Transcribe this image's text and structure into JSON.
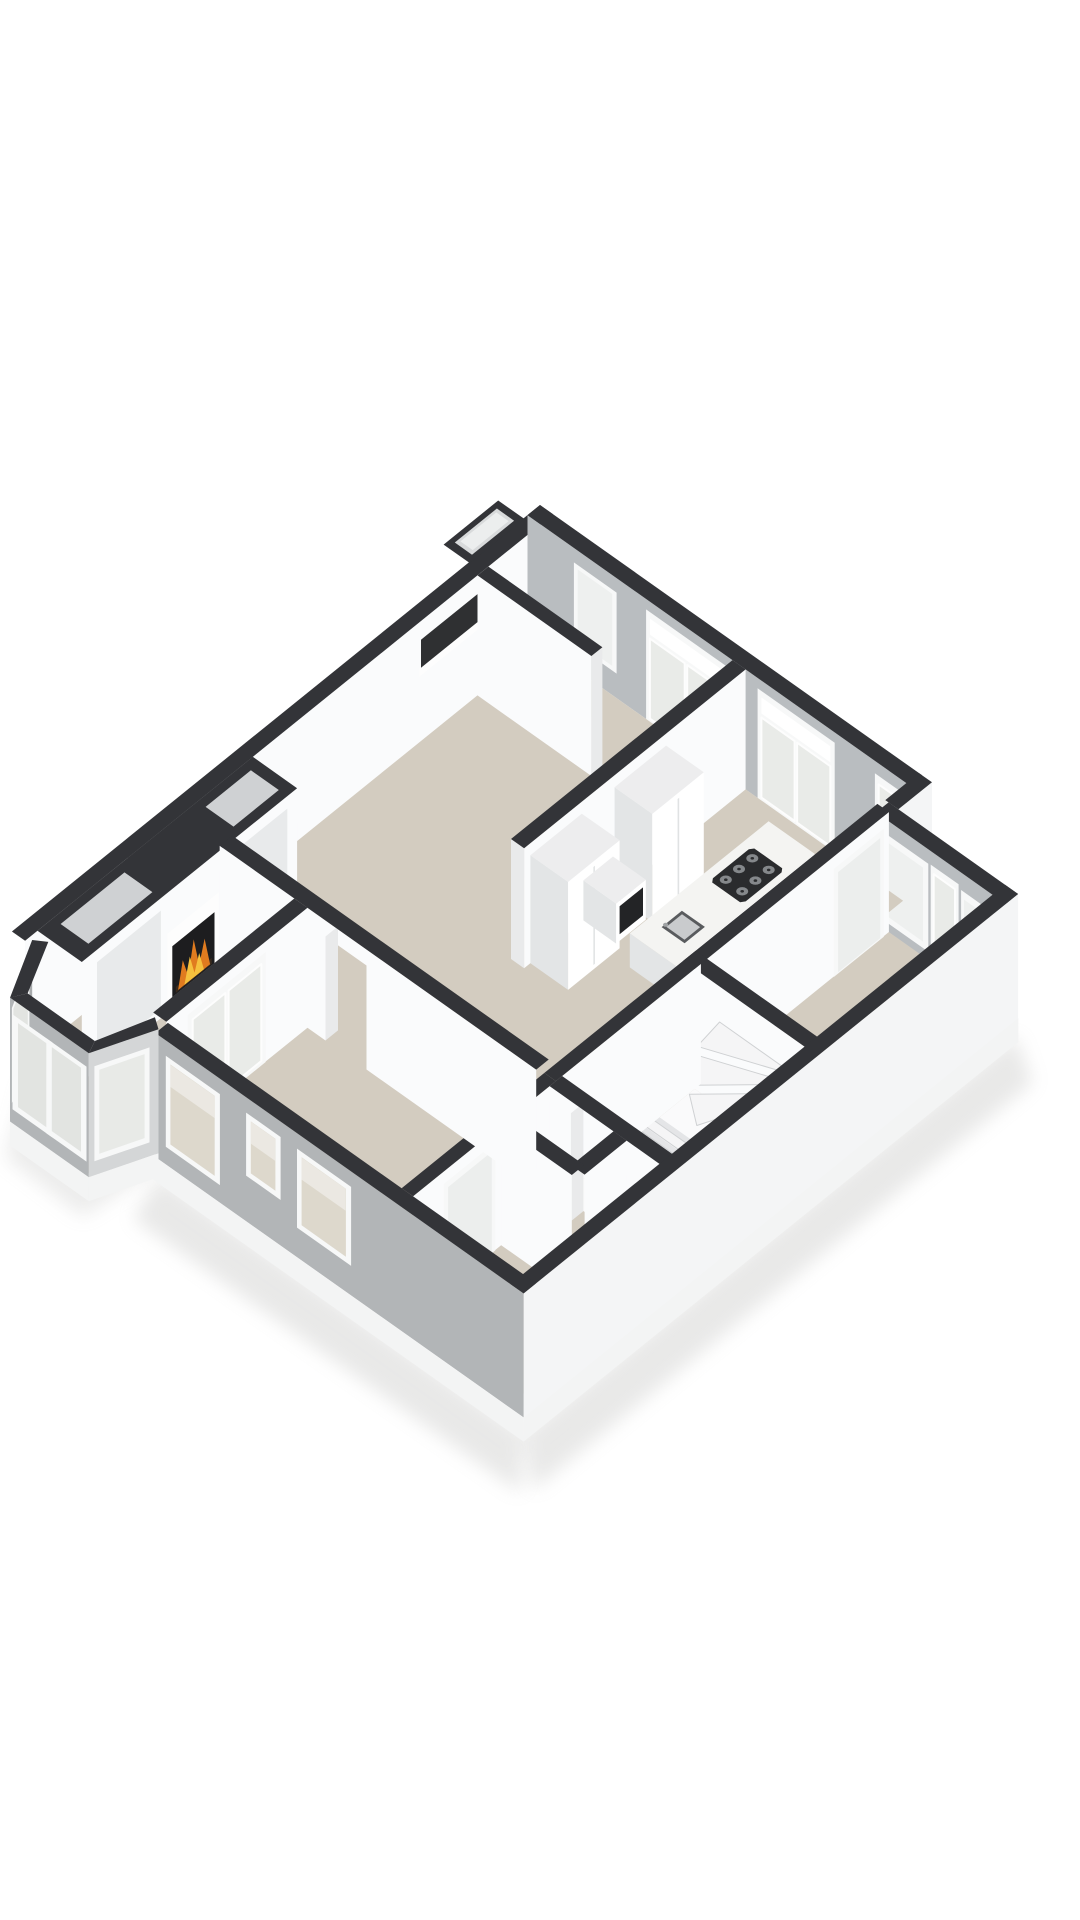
{
  "scene": {
    "label": "3D floor plan of a ground floor with living room with fireplace and bay window, galley kitchen with island, dining room, hallway and winding staircase",
    "background": "#ffffff"
  },
  "palette": {
    "floor": "#d3ccc0",
    "floorBay": "#d7d1c5",
    "stairFloor": "#fafafb",
    "wallTop": "#333438",
    "wallTopInt": "#3a3b3f",
    "intWhite": "#fafbfc",
    "intWhite2": "#f1f2f3",
    "intGrey": "#b9bdc0",
    "jamb": "#e9eaeb",
    "extGrey": "#b2b5b7",
    "extGreyDark": "#a7aaac",
    "extLight": "#f4f5f6",
    "slab": "#f3f4f4",
    "frame": "#f7f8f8",
    "glassInt": "#eef0ef",
    "glassDoor": "#e9ebe8",
    "glassExt": "#ddd8cc",
    "glassBay": "#e2e4e1",
    "nicheTop": "#cfd1d3",
    "nichePanel": "#e8eaeb",
    "cabinetFront": "#ffffff",
    "cabinetTop": "#ededee",
    "cabinetSide": "#e3e5e6",
    "islandTop": "#f4f4f2",
    "ovenDark": "#232426",
    "cooktop": "#2a2b2d",
    "burner": "#85888b",
    "burnerCenter": "#2b2c2e",
    "sinkRim": "#595b5e",
    "sinkBasin": "#c9cbcd",
    "fireBox": "#1d1d1f",
    "fireOrange": "#e07b1f",
    "fireYellow": "#f5c03d",
    "stepTop": "#f5f5f6",
    "stepRiser": "#e4e5e7",
    "stepEdge": "#cfd1d3",
    "railing": "#6a6d70",
    "shadow": "#b6b6b4"
  },
  "features": {
    "rooms": [
      "living-room",
      "kitchen",
      "dining-room",
      "hallway",
      "stairwell",
      "storage-closet"
    ],
    "objects": [
      "fireplace",
      "chimney",
      "slit-window",
      "bay-window",
      "tall-cabinets",
      "oven-recess",
      "kitchen-island",
      "gas-cooktop",
      "island-sink",
      "french-doors",
      "balcony-railing-window",
      "winding-stairs",
      "interior-double-doors",
      "facade-windows"
    ]
  }
}
